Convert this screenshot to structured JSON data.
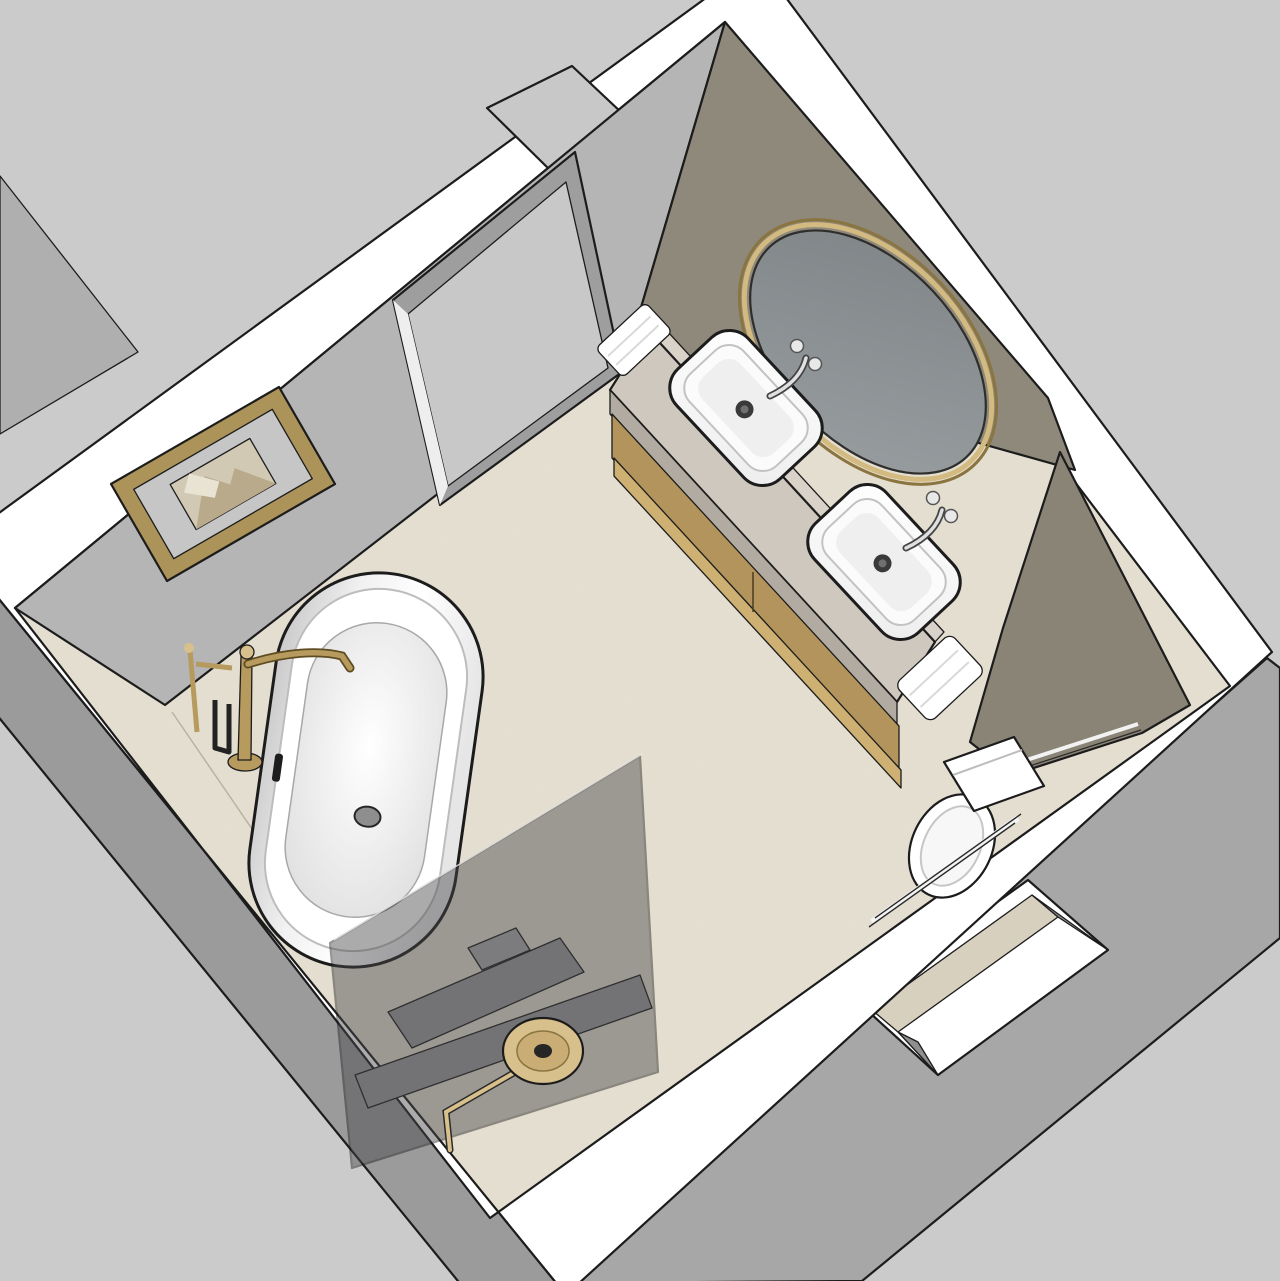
{
  "scene": {
    "type": "3d-room-render",
    "room": "bathroom-floorplan-perspective",
    "objects": [
      "freestanding-bathtub",
      "floor-mounted-tub-filler",
      "double-vanity",
      "vessel-sink-left",
      "vessel-sink-right",
      "oval-gold-mirror",
      "wall-hung-toilet",
      "toilet-partition-wall",
      "shower-glass-panel",
      "rain-shower-head",
      "framed-artwork",
      "doorway-with-door",
      "window-opening",
      "hand-towel-left",
      "hand-towel-right",
      "shower-bench"
    ]
  },
  "colors": {
    "bg": "#cbcbcb",
    "outline": "#1c1c1c",
    "wall_top": "#ffffff",
    "ext_sw": "#9b9b9b",
    "ext_se": "#a7a7a7",
    "interior": "#b5b5b5",
    "adjacent": "#afafaf",
    "door_panel": "#c8c8c8",
    "door_jamb": "#9e9e9e",
    "door_sliver": "#eeeeee",
    "floor": "#e5dfd1",
    "taupe": "#8f897b",
    "pony": "#8a8476",
    "counter": "#cfc8be",
    "counter_edge": "#b2aba1",
    "backsplash": "#d9d2c9",
    "wood": "#b2945c",
    "wood_light": "#cdb072",
    "white_fixture": "#ffffff",
    "frame_gold": "#ab935a",
    "mat": "#c6c6c6",
    "art_bg": "#d2c9b4",
    "art_shape": "#b9aa8c",
    "gold_rim": "#8a7440",
    "gold_light": "#d2ba80",
    "brass": "#b69a5e",
    "brass_light": "#d8c08c",
    "brass_dark": "#5f4d22",
    "glass_panel": "#46464a",
    "bench": "#9a9a9a",
    "bench2": "#aaaaaa",
    "sill": "#d8d0bf",
    "reveal": "#8f8f8f",
    "basin_shadow": "#efefef",
    "drain": "#3a3a3a"
  }
}
